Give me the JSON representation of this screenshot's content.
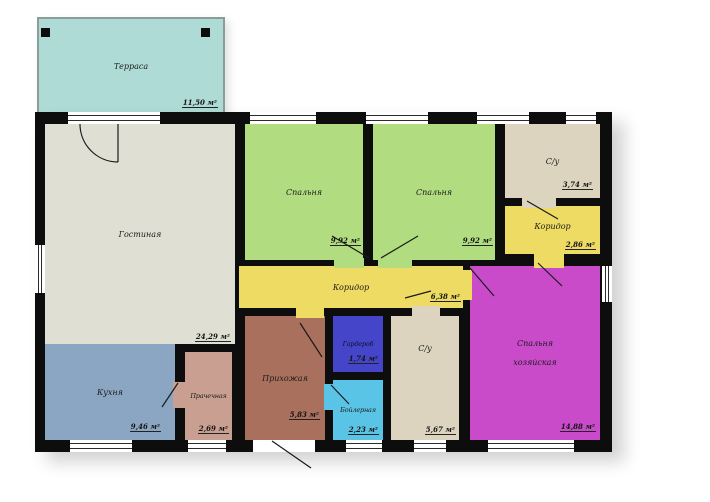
{
  "plan": {
    "type": "floor-plan",
    "language": "ru",
    "area_unit": "м²",
    "rooms": {
      "terrace": {
        "label": "Терраса",
        "area": "11,50 м²",
        "color": "#aedbd6"
      },
      "living": {
        "label": "Гостиная",
        "area": "24,29 м²",
        "color": "#dfe0d3"
      },
      "bedroom_left": {
        "label": "Спальня",
        "area": "9,92 м²",
        "color": "#b1dc80"
      },
      "bedroom_right": {
        "label": "Спальня",
        "area": "9,92 м²",
        "color": "#b1dc80"
      },
      "bathroom_top": {
        "label": "С/у",
        "area": "3,74 м²",
        "color": "#dcd4bf"
      },
      "corridor_top": {
        "label": "Коридор",
        "area": "2,86 м²",
        "color": "#eedb63"
      },
      "corridor_main": {
        "label": "Коридор",
        "area": "6,38 м²",
        "color": "#eedb63"
      },
      "kitchen": {
        "label": "Кухня",
        "area": "9,46 м²",
        "color": "#8ba6c3"
      },
      "laundry": {
        "label": "Прачечная",
        "area": "2,69 м²",
        "color": "#c89f91"
      },
      "hallway": {
        "label": "Прихожая",
        "area": "5,83 м²",
        "color": "#a9705e"
      },
      "wardrobe": {
        "label": "Гардероб",
        "area": "1,74 м²",
        "color": "#4545c9"
      },
      "boiler": {
        "label": "Бойлерная",
        "area": "2,23 м²",
        "color": "#5ac4e6"
      },
      "bathroom_bottom": {
        "label": "С/у",
        "area": "5,67 м²",
        "color": "#dcd4bf"
      },
      "master_bedroom": {
        "label": "Спальня хозяйская",
        "area": "14,88 м²",
        "color": "#c94bca"
      }
    },
    "wall_color": "#0d0d0d"
  }
}
